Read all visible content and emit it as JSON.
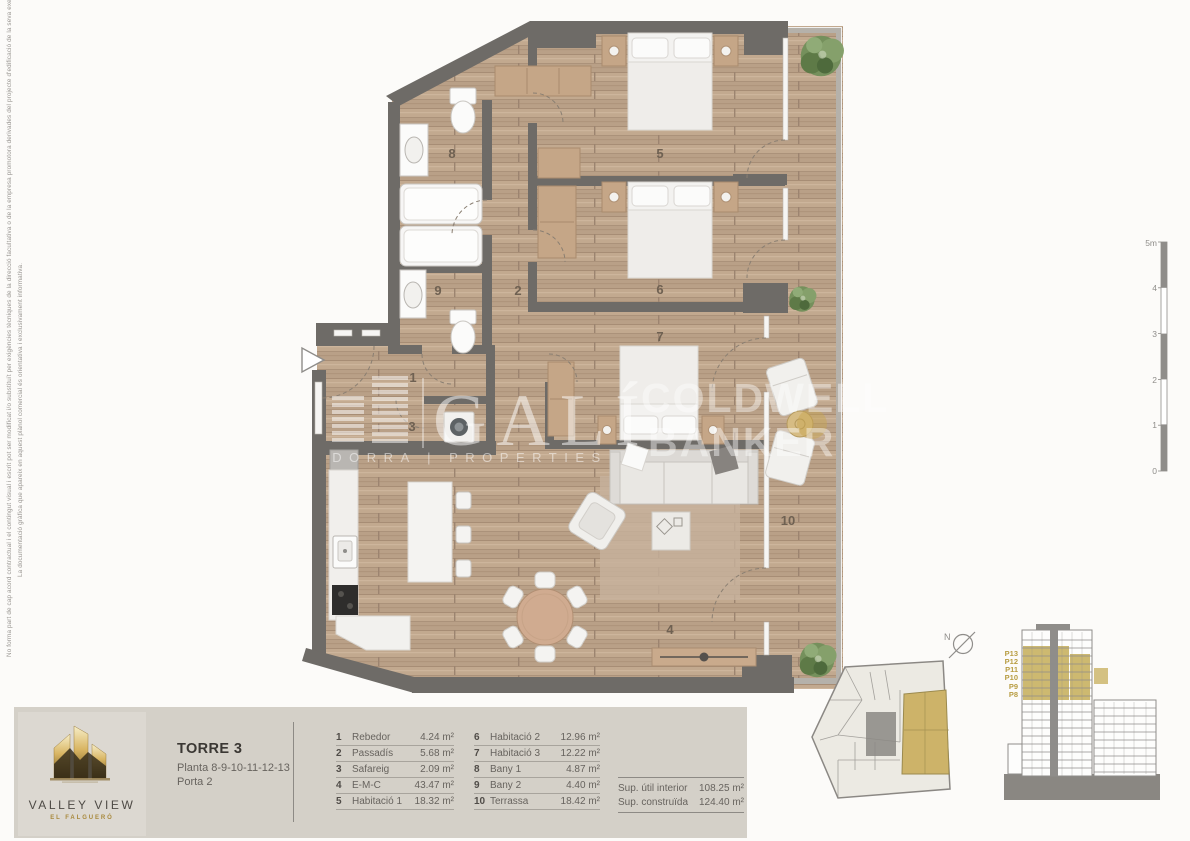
{
  "disclaimer": {
    "line1": "No forma part de cap acord contractual i el contingut visual i escrit pot ser modificat i/o substituït per exigències tècniques de la direcció facultativa o de la empresa promotora derivades del projecte d'edificació de la seva execució.",
    "line2": "La documentació gràfica que apareix en aquest plànol comercial és orientativa i exclusivament informativa."
  },
  "plan": {
    "rooms": [
      "1",
      "2",
      "3",
      "4",
      "5",
      "6",
      "7",
      "8",
      "9",
      "10"
    ]
  },
  "scalebar": {
    "labels": [
      "5m",
      "4",
      "3",
      "2",
      "1",
      "0"
    ]
  },
  "north": {
    "label": "N"
  },
  "elevation": {
    "floors": [
      "P13",
      "P12",
      "P11",
      "P10",
      "P9",
      "P8"
    ]
  },
  "watermarks": {
    "brand1_name": "GALÍ",
    "brand1_sub": "DORRA | PROPERTIES",
    "brand2_line1": "COLDWELL",
    "brand2_line2": "BANKER"
  },
  "footer": {
    "logo": {
      "title": "VALLEY VIEW",
      "subtitle": "EL FALGUERÓ"
    },
    "title": "TORRE 3",
    "subtitle1": "Planta 8-9-10-11-12-13",
    "subtitle2": "Porta 2",
    "legend": [
      {
        "num": "1",
        "name": "Rebedor",
        "area": "4.24 m²"
      },
      {
        "num": "2",
        "name": "Passadís",
        "area": "5.68 m²"
      },
      {
        "num": "3",
        "name": "Safareig",
        "area": "2.09 m²"
      },
      {
        "num": "4",
        "name": "E-M-C",
        "area": "43.47 m²"
      },
      {
        "num": "5",
        "name": "Habitació 1",
        "area": "18.32 m²"
      },
      {
        "num": "6",
        "name": "Habitació 2",
        "area": "12.96 m²"
      },
      {
        "num": "7",
        "name": "Habitació 3",
        "area": "12.22 m²"
      },
      {
        "num": "8",
        "name": "Bany 1",
        "area": "4.87 m²"
      },
      {
        "num": "9",
        "name": "Bany 2",
        "area": "4.40 m²"
      },
      {
        "num": "10",
        "name": "Terrassa",
        "area": "18.42 m²"
      }
    ],
    "totals": [
      {
        "label": "Sup. útil interior",
        "value": "108.25 m²"
      },
      {
        "label": "Sup. construïda",
        "value": "124.40 m²"
      }
    ]
  },
  "colors": {
    "wall": "#6e6b67",
    "wood": "#c1a78e",
    "accent_gold": "#c9b364",
    "band": "#d4d0c8",
    "line_gray": "#8f8d8a"
  }
}
